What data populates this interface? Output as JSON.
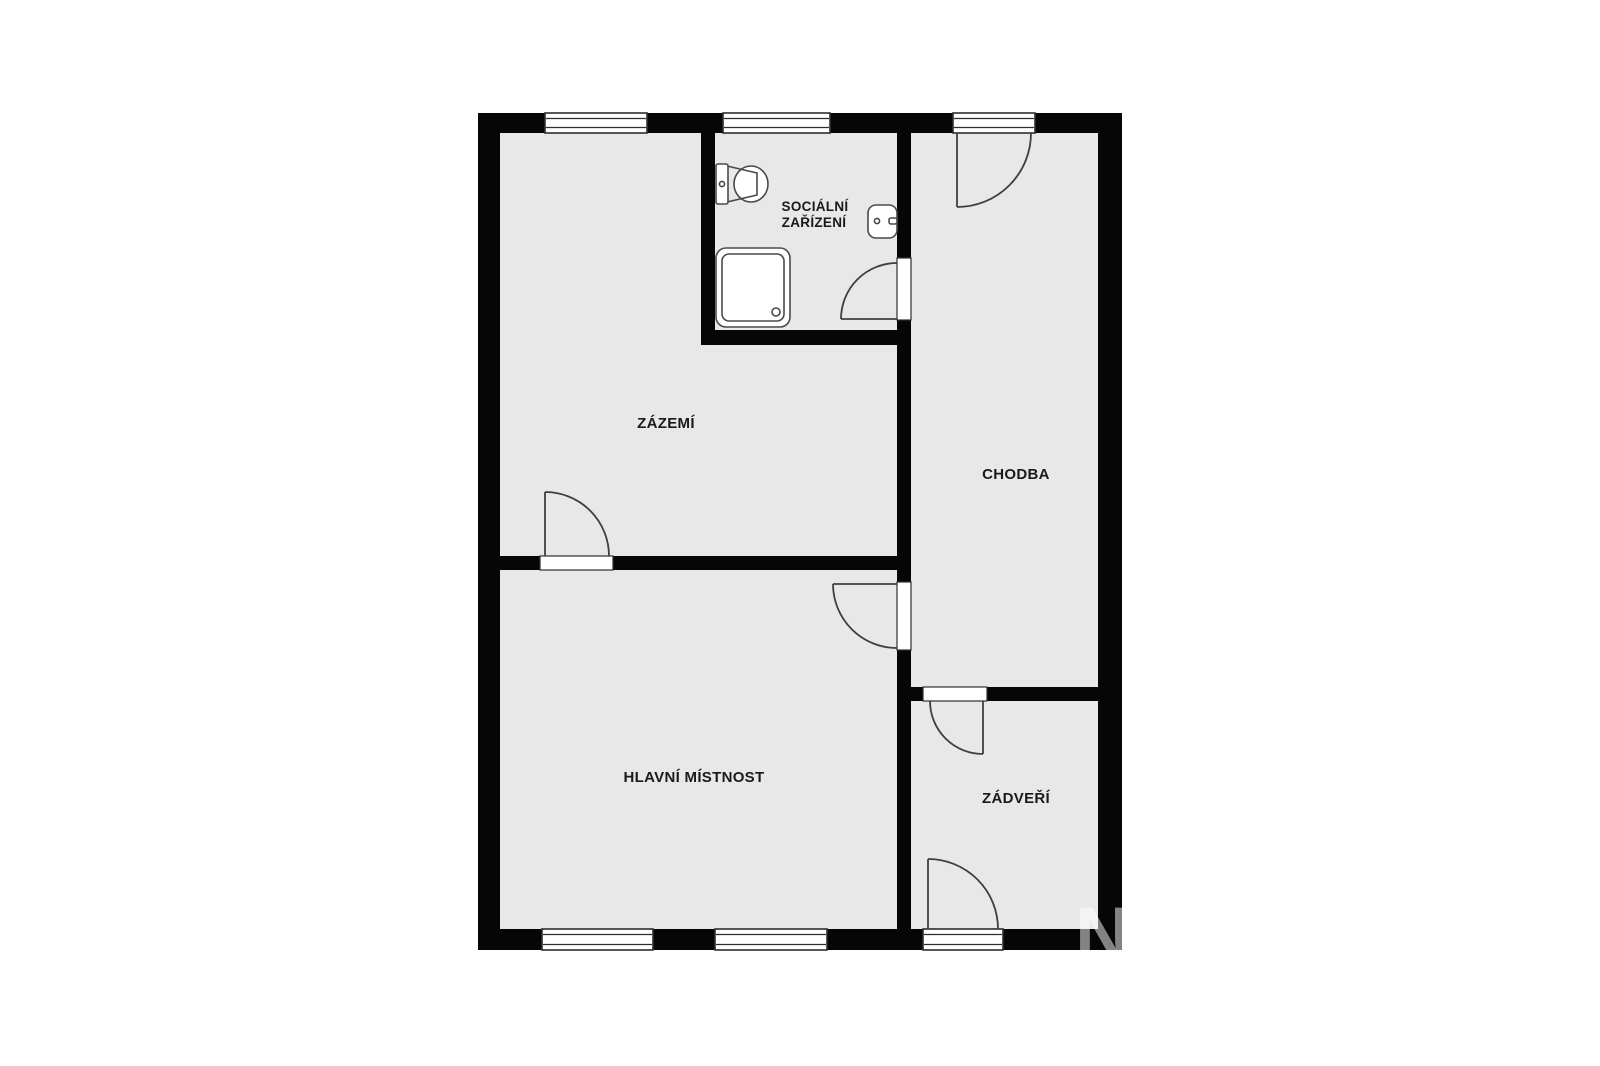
{
  "title": "Floor plan",
  "colors": {
    "background": "#ffffff",
    "wall": "#060606",
    "room_fill": "#e8e8e8",
    "line": "#3f3f3f",
    "text": "#1a1a1a",
    "watermark": "#ffffff"
  },
  "rooms": [
    {
      "id": "zazemi",
      "label": "ZÁZEMÍ"
    },
    {
      "id": "socialni-zarizeni",
      "label_lines": [
        "SOCIÁLNÍ",
        "ZAŘÍZENÍ"
      ]
    },
    {
      "id": "chodba",
      "label": "CHODBA"
    },
    {
      "id": "hlavni-mistnost",
      "label": "HLAVNÍ MÍSTNOST"
    },
    {
      "id": "zadveri",
      "label": "ZÁDVEŘÍ"
    }
  ],
  "fixtures": [
    {
      "id": "toilet",
      "name": "toilet"
    },
    {
      "id": "sink",
      "name": "wash basin"
    },
    {
      "id": "shower",
      "name": "shower tray"
    }
  ],
  "watermark": "N"
}
